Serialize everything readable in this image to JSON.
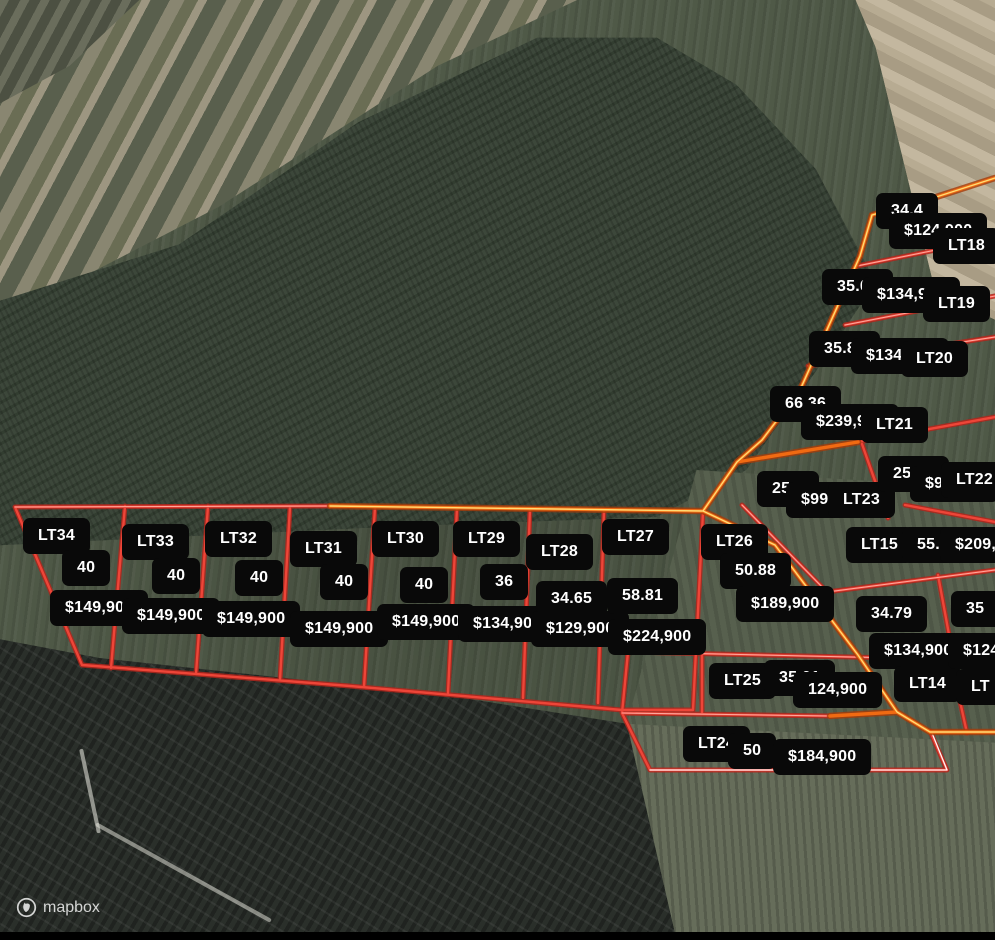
{
  "attribution": {
    "brand": "mapbox"
  },
  "colors": {
    "label_bg": "#090909",
    "label_text": "#ffffff",
    "line_red": "#e0382d",
    "line_red_core": "#ffaba2",
    "line_orange": "#ea6210",
    "line_orange_core": "#ffe27a",
    "line_white_core": "#ffffff"
  },
  "lots": [
    {
      "id": "lt34",
      "labels": [
        {
          "t": "LT34",
          "x": 23,
          "y": 518
        },
        {
          "t": "40",
          "x": 62,
          "y": 550
        },
        {
          "t": "$149,900",
          "x": 50,
          "y": 590
        }
      ]
    },
    {
      "id": "lt33",
      "labels": [
        {
          "t": "LT33",
          "x": 122,
          "y": 524
        },
        {
          "t": "40",
          "x": 152,
          "y": 558
        },
        {
          "t": "$149,900",
          "x": 122,
          "y": 598
        }
      ]
    },
    {
      "id": "lt32",
      "labels": [
        {
          "t": "LT32",
          "x": 205,
          "y": 521
        },
        {
          "t": "40",
          "x": 235,
          "y": 560
        },
        {
          "t": "$149,900",
          "x": 202,
          "y": 601
        }
      ]
    },
    {
      "id": "lt31",
      "labels": [
        {
          "t": "LT31",
          "x": 290,
          "y": 531
        },
        {
          "t": "40",
          "x": 320,
          "y": 564
        },
        {
          "t": "$149,900",
          "x": 290,
          "y": 611
        }
      ]
    },
    {
      "id": "lt30",
      "labels": [
        {
          "t": "LT30",
          "x": 372,
          "y": 521
        },
        {
          "t": "40",
          "x": 400,
          "y": 567
        },
        {
          "t": "$149,900",
          "x": 377,
          "y": 604
        }
      ]
    },
    {
      "id": "lt29",
      "labels": [
        {
          "t": "LT29",
          "x": 453,
          "y": 521
        },
        {
          "t": "36",
          "x": 480,
          "y": 564
        },
        {
          "t": "$134,900",
          "x": 458,
          "y": 606
        }
      ]
    },
    {
      "id": "lt28",
      "labels": [
        {
          "t": "LT28",
          "x": 526,
          "y": 534
        },
        {
          "t": "34.65",
          "x": 536,
          "y": 581
        },
        {
          "t": "$129,900",
          "x": 531,
          "y": 611
        }
      ]
    },
    {
      "id": "lt27",
      "labels": [
        {
          "t": "LT27",
          "x": 602,
          "y": 519
        },
        {
          "t": "58.81",
          "x": 607,
          "y": 578
        },
        {
          "t": "$224,900",
          "x": 608,
          "y": 619
        }
      ]
    },
    {
      "id": "lt26",
      "labels": [
        {
          "t": "LT26",
          "x": 701,
          "y": 524
        },
        {
          "t": "50.88",
          "x": 720,
          "y": 553
        },
        {
          "t": "$189,900",
          "x": 736,
          "y": 586
        }
      ]
    },
    {
      "id": "lt25",
      "labels": [
        {
          "t": "LT25",
          "x": 709,
          "y": 663
        },
        {
          "t": "35.01",
          "x": 764,
          "y": 660
        },
        {
          "t": "124,900",
          "x": 793,
          "y": 672
        }
      ]
    },
    {
      "id": "lt24",
      "labels": [
        {
          "t": "LT24",
          "x": 683,
          "y": 726
        },
        {
          "t": "50",
          "x": 728,
          "y": 733
        },
        {
          "t": "$184,900",
          "x": 773,
          "y": 739
        }
      ]
    },
    {
      "id": "lt23",
      "labels": [
        {
          "t": "25.5",
          "x": 757,
          "y": 471
        },
        {
          "t": "$99,900",
          "x": 786,
          "y": 482
        },
        {
          "t": "LT23",
          "x": 828,
          "y": 482
        }
      ]
    },
    {
      "id": "lt22",
      "labels": [
        {
          "t": "25.04",
          "x": 878,
          "y": 456
        },
        {
          "t": "$99,900",
          "x": 910,
          "y": 466
        },
        {
          "t": "LT22",
          "x": 941,
          "y": 462
        }
      ]
    },
    {
      "id": "lt21",
      "labels": [
        {
          "t": "66.36",
          "x": 770,
          "y": 386
        },
        {
          "t": "$239,900",
          "x": 801,
          "y": 404
        },
        {
          "t": "LT21",
          "x": 861,
          "y": 407
        }
      ]
    },
    {
      "id": "lt20",
      "labels": [
        {
          "t": "35.81",
          "x": 809,
          "y": 331
        },
        {
          "t": "$134,900",
          "x": 851,
          "y": 338
        },
        {
          "t": "LT20",
          "x": 901,
          "y": 341
        }
      ]
    },
    {
      "id": "lt19",
      "labels": [
        {
          "t": "35.07",
          "x": 822,
          "y": 269
        },
        {
          "t": "$134,900",
          "x": 862,
          "y": 277
        },
        {
          "t": "LT19",
          "x": 923,
          "y": 286
        }
      ]
    },
    {
      "id": "lt18",
      "labels": [
        {
          "t": "34.4",
          "x": 876,
          "y": 193
        },
        {
          "t": "$124,900",
          "x": 889,
          "y": 213
        },
        {
          "t": "LT18",
          "x": 933,
          "y": 228
        }
      ]
    },
    {
      "id": "lt15",
      "labels": [
        {
          "t": "LT15",
          "x": 846,
          "y": 527
        },
        {
          "t": "55.15",
          "x": 902,
          "y": 527
        },
        {
          "t": "$209,90",
          "x": 940,
          "y": 527,
          "w": 100
        }
      ]
    },
    {
      "id": "lt14",
      "labels": [
        {
          "t": "34.79",
          "x": 856,
          "y": 596
        },
        {
          "t": "$134,900",
          "x": 869,
          "y": 633
        },
        {
          "t": "LT14",
          "x": 894,
          "y": 666
        }
      ]
    },
    {
      "id": "lt13-partial",
      "labels": [
        {
          "t": "35",
          "x": 951,
          "y": 591,
          "w": 72
        },
        {
          "t": "$124,9",
          "x": 948,
          "y": 633,
          "w": 100
        },
        {
          "t": "LT",
          "x": 956,
          "y": 669,
          "w": 75
        }
      ]
    }
  ]
}
